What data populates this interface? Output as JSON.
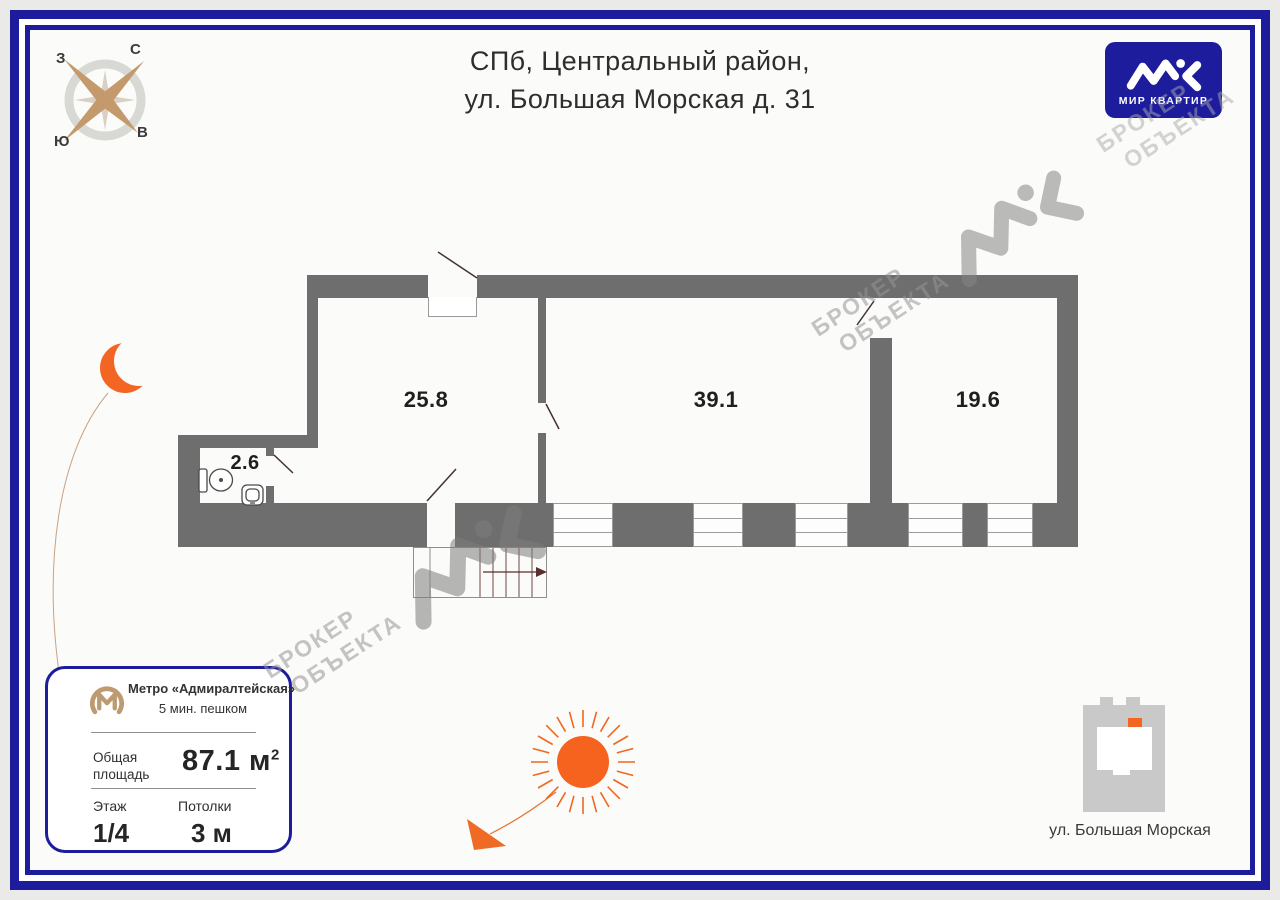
{
  "header": {
    "title_line1": "СПб, Центральный район,",
    "title_line2": "ул. Большая Морская д. 31"
  },
  "brand": {
    "name": "МИР КВАРТИР"
  },
  "compass": {
    "north": "С",
    "east": "В",
    "south": "Ю",
    "west": "З"
  },
  "plan": {
    "rooms": [
      {
        "name": "room-1",
        "area": "25.8"
      },
      {
        "name": "room-2",
        "area": "39.1"
      },
      {
        "name": "room-3",
        "area": "19.6"
      },
      {
        "name": "bathroom",
        "area": "2.6"
      }
    ]
  },
  "watermark": {
    "line1": "БРОКЕР",
    "line2": "ОБЪЕКТА"
  },
  "info_card": {
    "metro_station": "Метро «Адмиралтейская»",
    "metro_walk_time": "5 мин. пешком",
    "area_label": "Общая площадь",
    "area_value": "87.1 м",
    "area_sup": "2",
    "floor_label": "Этаж",
    "floor_value": "1/4",
    "ceiling_label": "Потолки",
    "ceiling_value": "3 м"
  },
  "minimap": {
    "street": "ул. Большая Морская"
  },
  "colors": {
    "brand_blue": "#1c1c9d",
    "accent_orange": "#f26522",
    "wall_gray": "#6e6e6e",
    "compass_tan": "#c49a6c",
    "watermark_gray": "#b5b5b5"
  }
}
